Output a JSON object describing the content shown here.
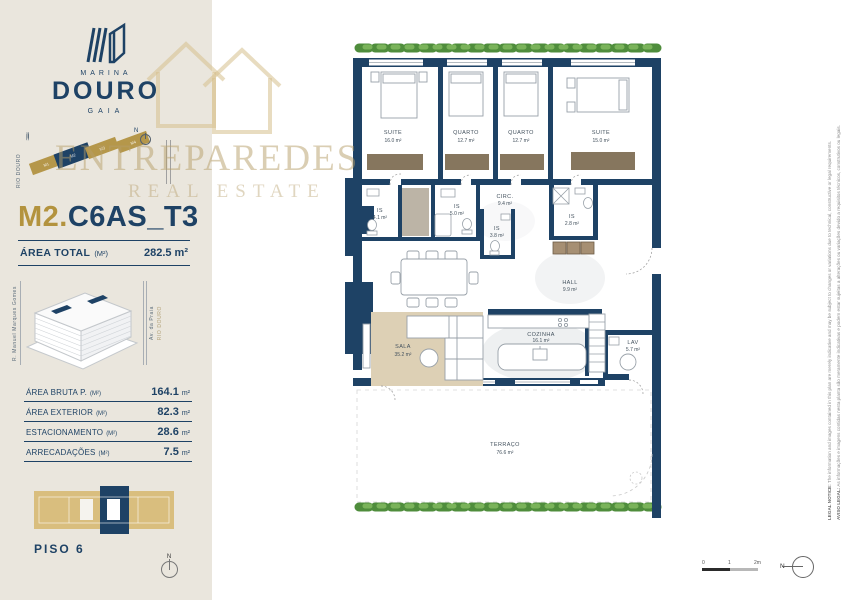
{
  "colors": {
    "navy": "#1e4265",
    "gold": "#b3933e",
    "beige": "#eae6dd",
    "keyplan_gold": "#d9be7e",
    "hedge_green": "#4f8d3c",
    "watermark": "#b69d68"
  },
  "brand": {
    "name_top": "MARINA",
    "name_main": "DOURO",
    "name_sub": "GAIA"
  },
  "watermark": {
    "line1": "ENTREPAREDES",
    "line2": "REAL ESTATE"
  },
  "sitemap": {
    "river": "RIO DOURO",
    "river_waves": "≈≈≈≈",
    "north": "N",
    "blocks": [
      "M1",
      "M2",
      "M3",
      "M4"
    ]
  },
  "unit": {
    "prefix": "M2.",
    "code": "C6AS_T3"
  },
  "area_total": {
    "label": "ÁREA TOTAL",
    "unit": "(M²)",
    "value": "282.5 m²"
  },
  "building": {
    "street_left": "R. Manuel Marques Gomes",
    "street_right": "Av. da Praia",
    "river": "RIO DOURO"
  },
  "areas_table": {
    "rows": [
      {
        "label": "ÁREA BRUTA P.",
        "unit": "(M²)",
        "value": "164.1",
        "suffix": "m²"
      },
      {
        "label": "ÁREA EXTERIOR",
        "unit": "(M²)",
        "value": "82.3",
        "suffix": "m²"
      },
      {
        "label": "ESTACIONAMENTO",
        "unit": "(M²)",
        "value": "28.6",
        "suffix": "m²"
      },
      {
        "label": "ARRECADAÇÕES",
        "unit": "(M²)",
        "value": "7.5",
        "suffix": "m²"
      }
    ]
  },
  "floor": {
    "label": "PISO 6"
  },
  "compass": {
    "label": "N"
  },
  "scalebar": {
    "zero": "0",
    "one": "1",
    "two": "2m"
  },
  "plan": {
    "rooms": {
      "suite1": {
        "name": "SUITE",
        "area": "16.0 m²"
      },
      "quarto1": {
        "name": "QUARTO",
        "area": "12.7 m²"
      },
      "quarto2": {
        "name": "QUARTO",
        "area": "12.7 m²"
      },
      "suite2": {
        "name": "SUITE",
        "area": "15.0 m²"
      },
      "circ": {
        "name": "CIRC.",
        "area": "9.4 m²"
      },
      "is1": {
        "name": "IS",
        "area": "4.1 m²"
      },
      "is2": {
        "name": "IS",
        "area": "5.0 m²"
      },
      "is3": {
        "name": "IS",
        "area": "3.8 m²"
      },
      "is4": {
        "name": "IS",
        "area": "2.8 m²"
      },
      "hall": {
        "name": "HALL",
        "area": "9.9 m²"
      },
      "sala": {
        "name": "SALA",
        "area": "35.2 m²"
      },
      "cozinha": {
        "name": "COZINHA",
        "area": "16.1 m²"
      },
      "lav": {
        "name": "LAV",
        "area": "5.7 m²"
      },
      "terraco": {
        "name": "TERRAÇO",
        "area": "76.6 m²"
      }
    }
  },
  "legal": {
    "en_label": "LEGAL NOTICE:",
    "en_text": " The information and images contained in this plan are merely indicative and may be subject to changes or variations due to technical, constructive or legal requirements.",
    "pt_label": "AVISO LEGAL:",
    "pt_text": " As informações e imagens contidas nesta planta são meramente indicativas e podem estar sujeitas a alterações ou variações devido a requisitos técnicos, construtivos ou legais."
  }
}
